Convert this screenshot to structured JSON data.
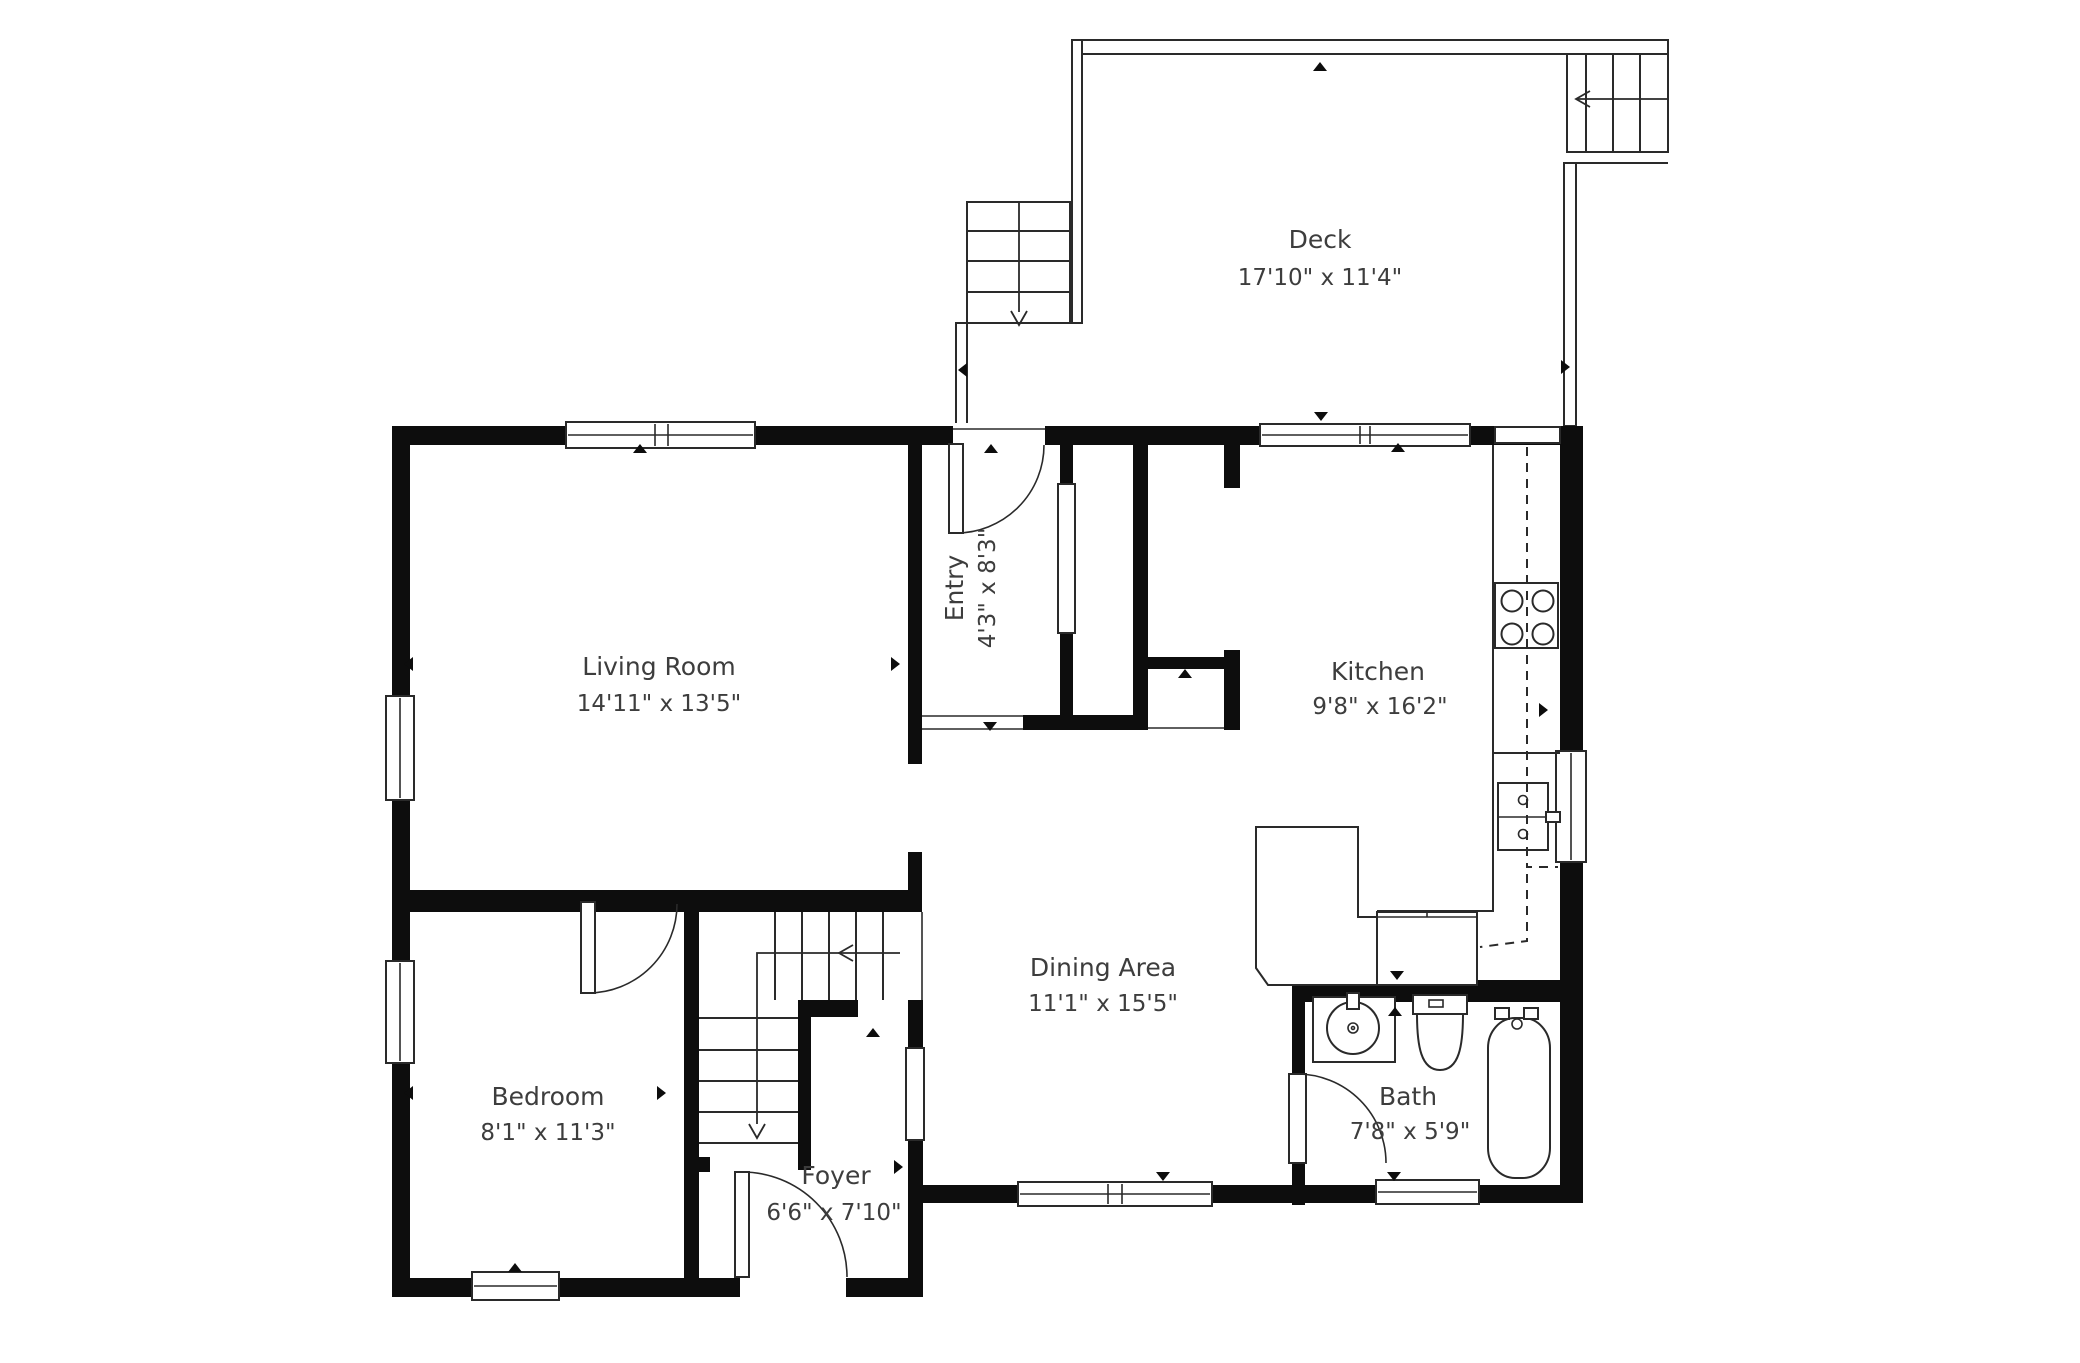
{
  "plan": {
    "title": "Floor plan",
    "colors": {
      "wall": "#0d0d0d",
      "line": "#2a2a2a",
      "text": "#3d3d3d",
      "background": "#ffffff"
    },
    "rooms": [
      {
        "id": "deck",
        "name": "Deck",
        "dims": "17'10\" x 11'4\""
      },
      {
        "id": "living",
        "name": "Living Room",
        "dims": "14'11\" x 13'5\""
      },
      {
        "id": "entry",
        "name": "Entry",
        "dims": "4'3\" x 8'3\""
      },
      {
        "id": "kitchen",
        "name": "Kitchen",
        "dims": "9'8\" x 16'2\""
      },
      {
        "id": "dining",
        "name": "Dining Area",
        "dims": "11'1\" x 15'5\""
      },
      {
        "id": "bedroom",
        "name": "Bedroom",
        "dims": "8'1\" x 11'3\""
      },
      {
        "id": "foyer",
        "name": "Foyer",
        "dims": "6'6\" x 7'10\""
      },
      {
        "id": "bath",
        "name": "Bath",
        "dims": "7'8\" x 5'9\""
      }
    ]
  }
}
